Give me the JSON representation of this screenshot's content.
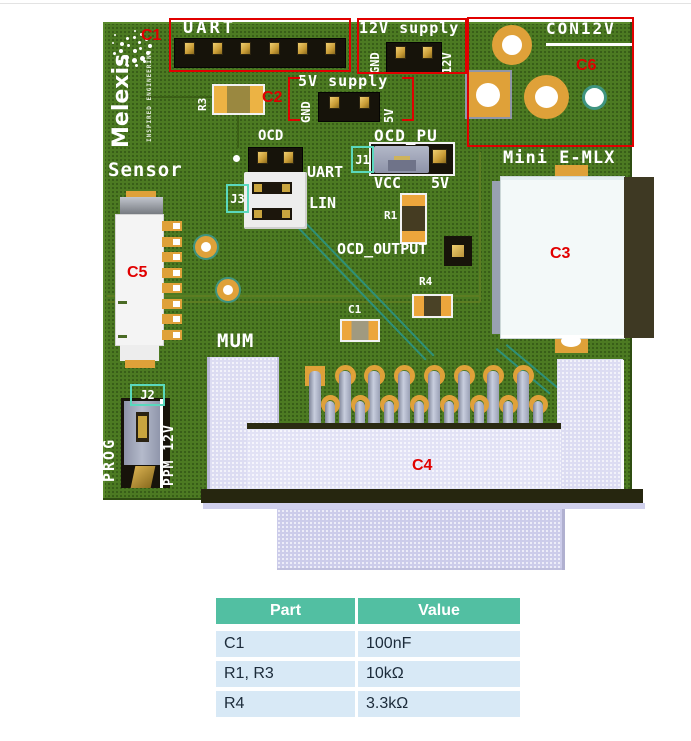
{
  "pcb": {
    "brand": "Melexis",
    "brand_tagline": "INSPIRED ENGINEERING",
    "silkscreen": {
      "uart_header": "UART",
      "supply_12v": "12V supply",
      "supply_12v_gnd": "GND",
      "supply_12v_pin": "12V",
      "con12v": "CON12V",
      "supply_5v": "5V supply",
      "supply_5v_gnd": "GND",
      "supply_5v_pin": "5V",
      "r3": "R3",
      "ocd": "OCD",
      "j3": "J3",
      "j3_uart": "UART",
      "j3_lin": "LIN",
      "ocd_pu": "OCD_PU",
      "j1": "J1",
      "j1_vcc": "VCC",
      "j1_5v": "5V",
      "r1": "R1",
      "ocd_output": "OCD_OUTPUT",
      "r4": "R4",
      "c1": "C1",
      "sensor": "Sensor",
      "mum": "MUM",
      "mini_emlx": "Mini E-MLX",
      "j2": "J2",
      "j2_prog": "PROG",
      "j2_ppm": "PPM 12V"
    },
    "callouts": {
      "c1": "C1",
      "c2": "C2",
      "c3": "C3",
      "c4": "C4",
      "c5": "C5",
      "c6": "C6"
    }
  },
  "table": {
    "headers": [
      "Part",
      "Value"
    ],
    "rows": [
      [
        "C1",
        "100nF"
      ],
      [
        "R1, R3",
        "10kΩ"
      ],
      [
        "R4",
        "3.3kΩ"
      ]
    ]
  },
  "colors": {
    "red": "#e10000",
    "teal": "#5ad8bd",
    "green": "#4c7a22",
    "gold": "#dfa139",
    "thead": "#52bfa2",
    "trow": "#d8e9f6",
    "ttext": "#1c2b3a",
    "lav": "#dcdcf2"
  }
}
